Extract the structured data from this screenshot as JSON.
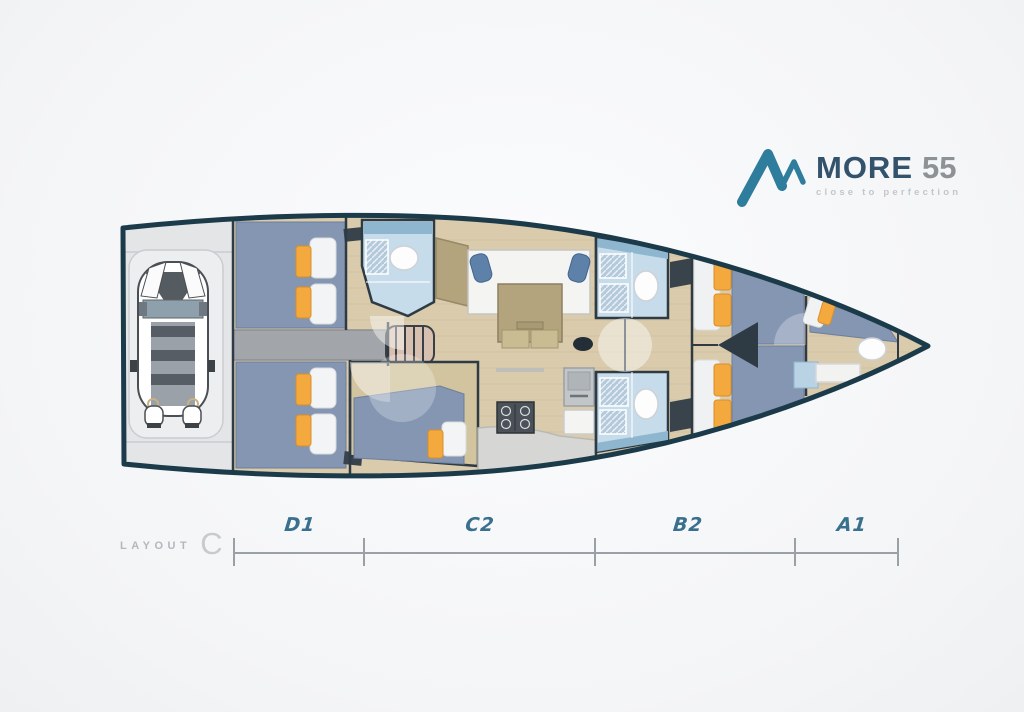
{
  "branding": {
    "name": "MORE",
    "model": "55",
    "tagline": "close to perfection"
  },
  "footer": {
    "layout_word": "LAYOUT",
    "layout_variant": "C"
  },
  "scale": {
    "sections": [
      {
        "label": "D1"
      },
      {
        "label": "C2"
      },
      {
        "label": "B2"
      },
      {
        "label": "A1"
      }
    ]
  },
  "colors": {
    "accent_teal": "#2e7d9c",
    "brand_navy": "#33526b",
    "brand_gray": "#8d9297",
    "section_label_teal": "#39708e",
    "hull_outline": "#1c3b4a",
    "berth_blue": "#8496b2",
    "cushion_orange": "#f3a93e",
    "bathroom_blue": "#c6dcea",
    "wood_floor": "#d9cbab",
    "counter_gray": "#d6d6d4"
  },
  "diagram": {
    "type": "yacht-interior-deck-plan",
    "orientation": "bow-right",
    "rooms": [
      "tender-garage",
      "aft-cabin-port",
      "aft-cabin-starboard",
      "engine-compartment",
      "companionway-stairs",
      "aft-head",
      "mid-cabin-starboard",
      "salon-dinette",
      "galley",
      "port-head",
      "starboard-head",
      "forward-cabin-port",
      "forward-cabin-starboard",
      "bow-cabin",
      "bow-head"
    ]
  }
}
